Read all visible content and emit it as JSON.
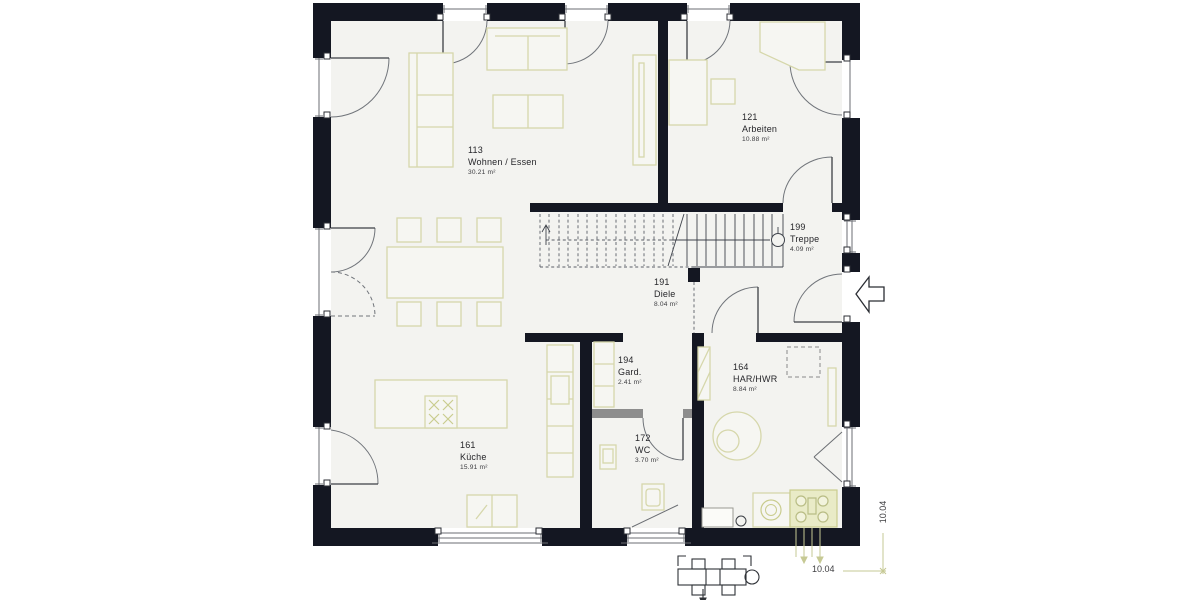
{
  "drawing_type": "house-floor-plan",
  "rooms": {
    "wohnen": {
      "number": "113",
      "name": "Wohnen / Essen",
      "area": "30.21 m²"
    },
    "arbeiten": {
      "number": "121",
      "name": "Arbeiten",
      "area": "10.88 m²"
    },
    "treppe": {
      "number": "199",
      "name": "Treppe",
      "area": "4.09 m²"
    },
    "diele": {
      "number": "191",
      "name": "Diele",
      "area": "8.04 m²"
    },
    "gard": {
      "number": "194",
      "name": "Gard.",
      "area": "2.41 m²"
    },
    "har": {
      "number": "164",
      "name": "HAR/HWR",
      "area": "8.84 m²"
    },
    "wc": {
      "number": "172",
      "name": "WC",
      "area": "3.70 m²"
    },
    "kueche": {
      "number": "161",
      "name": "Küche",
      "area": "15.91 m²"
    }
  },
  "dimensions": {
    "bottom": "10.04",
    "right": "10.04"
  },
  "colors": {
    "wall": "#141722",
    "interior": "#f3f3f0",
    "furniture_line": "#d6d7ab",
    "appliance_fill": "#e9ebc7",
    "partition_gray": "#8d8d8d",
    "dimension_line": "#c6c994",
    "door_arc": "#70747a",
    "label_text": "#26262a"
  }
}
